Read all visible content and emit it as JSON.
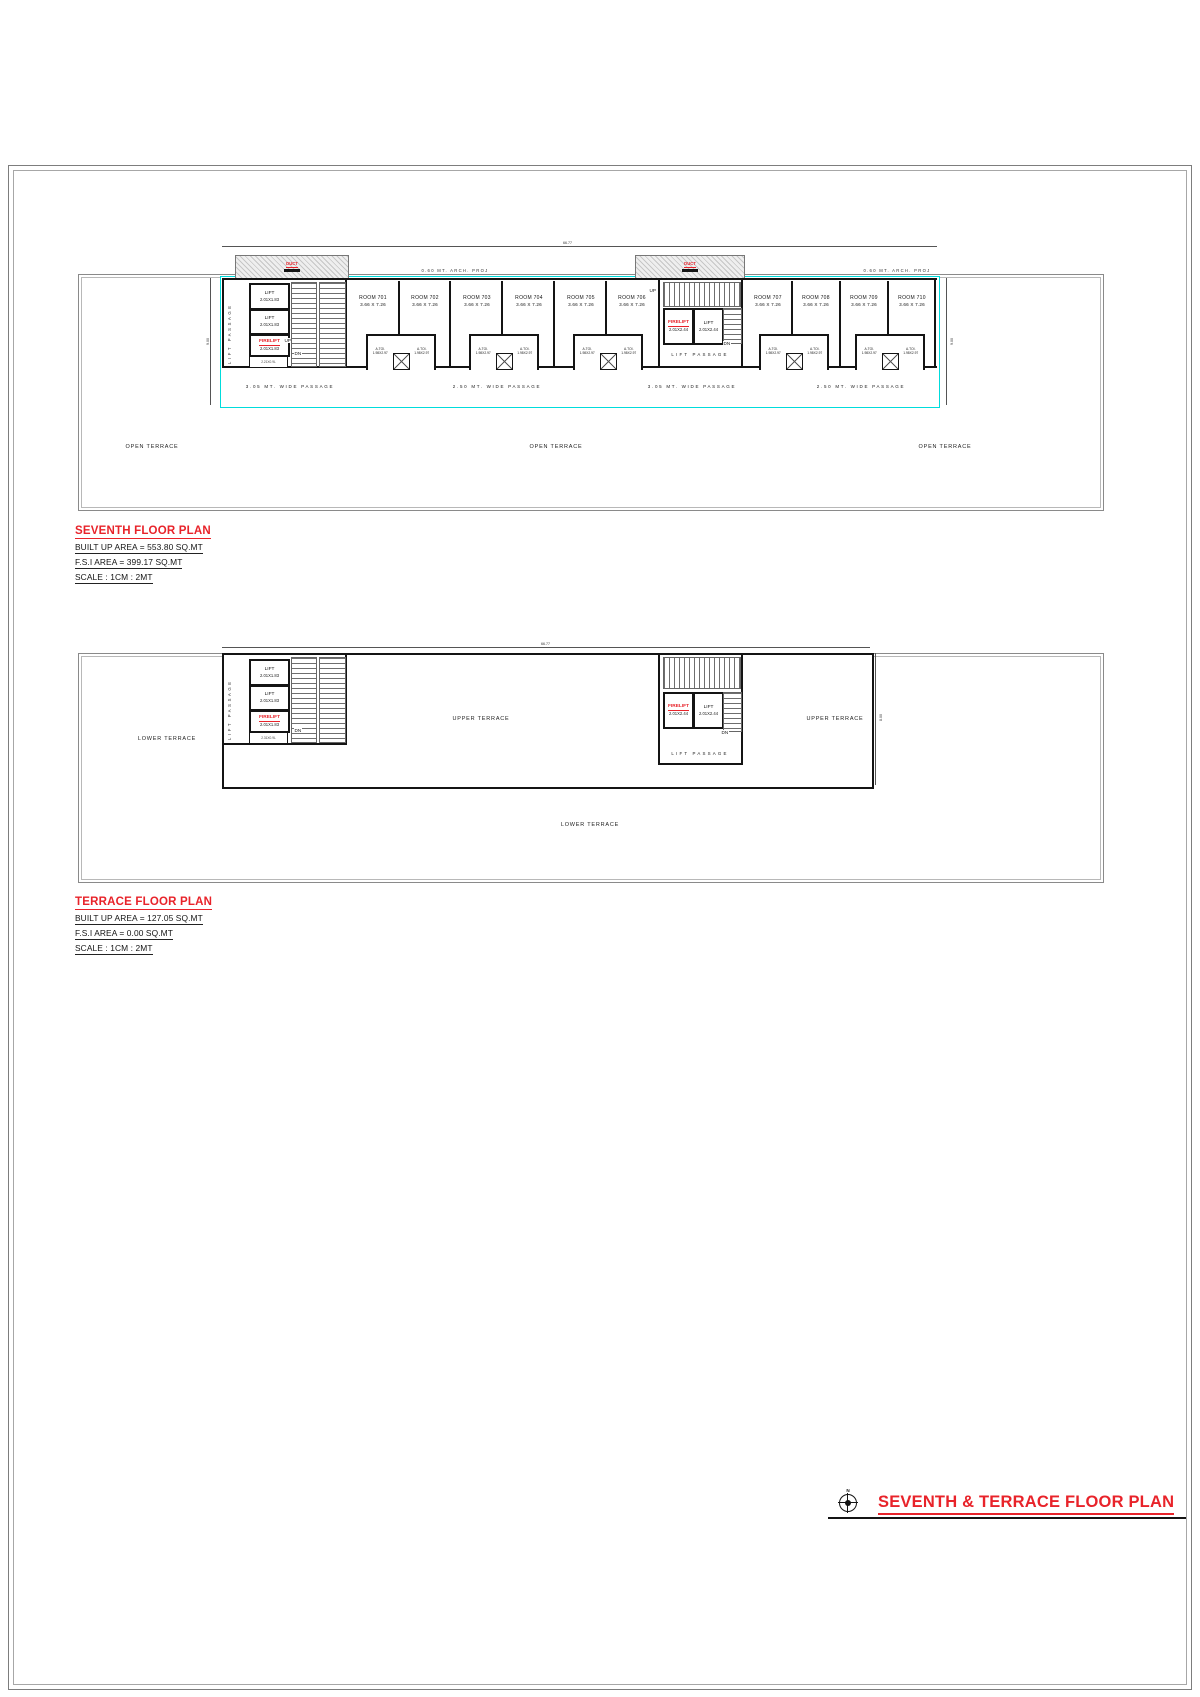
{
  "title_block": {
    "title": "SEVENTH & TERRACE FLOOR PLAN",
    "north": "N"
  },
  "colors": {
    "accent_red": "#e8232a",
    "passage_cyan": "#00dcdc",
    "wall_black": "#141414",
    "boundary_gray": "#8a8a8a"
  },
  "seventh": {
    "heading": "SEVENTH FLOOR PLAN",
    "built_up": "BUILT UP AREA = 553.80 SQ.MT",
    "fsi": "F.S.I AREA = 399.17 SQ.MT",
    "scale": "SCALE : 1CM : 2MT",
    "dim_width": "66.77",
    "dim_depth": "9.00",
    "arch_proj": "0.60 MT. ARCH. PROJ",
    "open_terrace": "OPEN TERRACE",
    "lift_passage": "LIFT PASSAGE",
    "hatch_label": "DUCT",
    "up": "UP",
    "dn": "DN",
    "lifts_side": [
      {
        "label": "LIFT",
        "dim": "2.01X1.83"
      },
      {
        "label": "LIFT",
        "dim": "2.01X1.83"
      },
      {
        "label": "FIRELIFT",
        "dim": "2.01X1.83"
      }
    ],
    "duct_box": "2.21X0.9L",
    "lifts_center": [
      {
        "label": "FIRELIFT",
        "dim": "2.01X2.44"
      },
      {
        "label": "LIFT",
        "dim": "2.01X2.44"
      }
    ],
    "rooms": [
      {
        "name": "ROOM 701",
        "dim": "3.66 X 7.26"
      },
      {
        "name": "ROOM 702",
        "dim": "3.66 X 7.26"
      },
      {
        "name": "ROOM 703",
        "dim": "3.66 X 7.26"
      },
      {
        "name": "ROOM 704",
        "dim": "3.66 X 7.26"
      },
      {
        "name": "ROOM 705",
        "dim": "3.66 X 7.26"
      },
      {
        "name": "ROOM 706",
        "dim": "3.66 X 7.26"
      },
      {
        "name": "ROOM 707",
        "dim": "3.66 X 7.26"
      },
      {
        "name": "ROOM 708",
        "dim": "3.66 X 7.26"
      },
      {
        "name": "ROOM 709",
        "dim": "3.66 X 7.26"
      },
      {
        "name": "ROOM 710",
        "dim": "3.66 X 7.26"
      }
    ],
    "toilet": {
      "label": "A.TOI.",
      "dim": "1.98X2.97"
    },
    "passages": [
      "3.05 MT. WIDE PASSAGE",
      "2.50 MT. WIDE PASSAGE",
      "3.05 MT. WIDE PASSAGE",
      "2.50 MT. WIDE PASSAGE"
    ]
  },
  "terrace": {
    "heading": "TERRACE FLOOR PLAN",
    "built_up": "BUILT UP AREA = 127.05 SQ.MT",
    "fsi": "F.S.I AREA = 0.00 SQ.MT",
    "scale": "SCALE : 1CM : 2MT",
    "dim_width": "66.77",
    "dim_depth": "8.00",
    "upper_terrace": "UPPER TERRACE",
    "lower_terrace": "LOWER TERRACE",
    "lift_passage": "LIFT PASSAGE",
    "dn": "DN",
    "lifts_side": [
      {
        "label": "LIFT",
        "dim": "2.01X1.83"
      },
      {
        "label": "LIFT",
        "dim": "2.01X1.83"
      },
      {
        "label": "FIRELIFT",
        "dim": "2.01X1.83"
      }
    ],
    "duct_box": "2.31X0.9L",
    "lifts_center": [
      {
        "label": "FIRELIFT",
        "dim": "2.01X2.44"
      },
      {
        "label": "LIFT",
        "dim": "2.01X2.44"
      }
    ]
  }
}
